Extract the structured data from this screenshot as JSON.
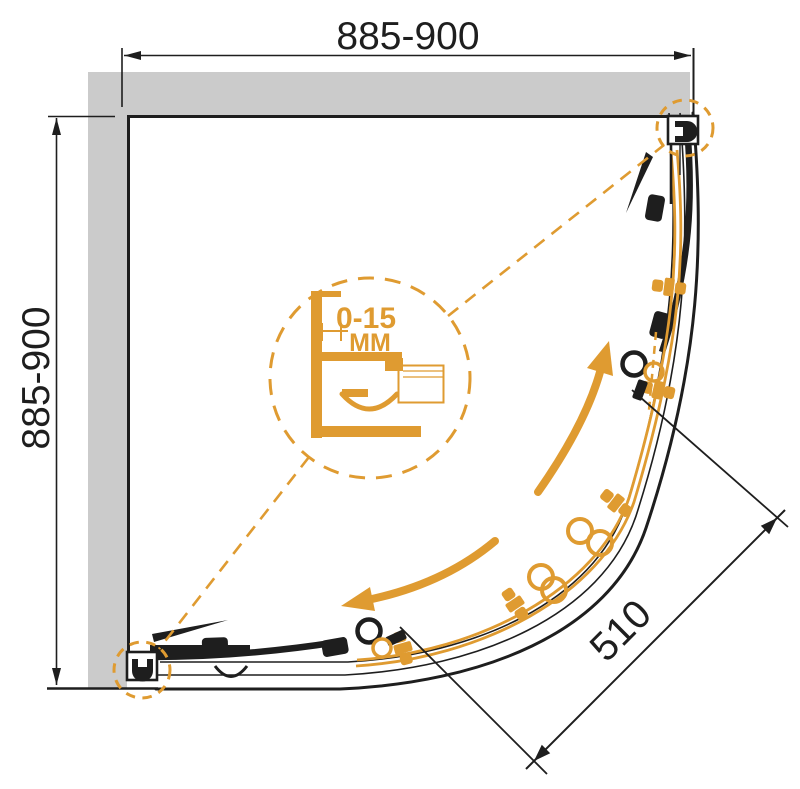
{
  "drawing": {
    "title": "Quadrant shower enclosure - plan view technical drawing",
    "dimensions": {
      "top": "885-900",
      "left": "885-900",
      "opening": "510"
    },
    "detail": {
      "range": "0-15",
      "unit": "MM"
    },
    "colors": {
      "accent_orange": "#df9b31",
      "wall_gray": "#cbcbcb",
      "line_black": "#1e1e1e"
    }
  }
}
